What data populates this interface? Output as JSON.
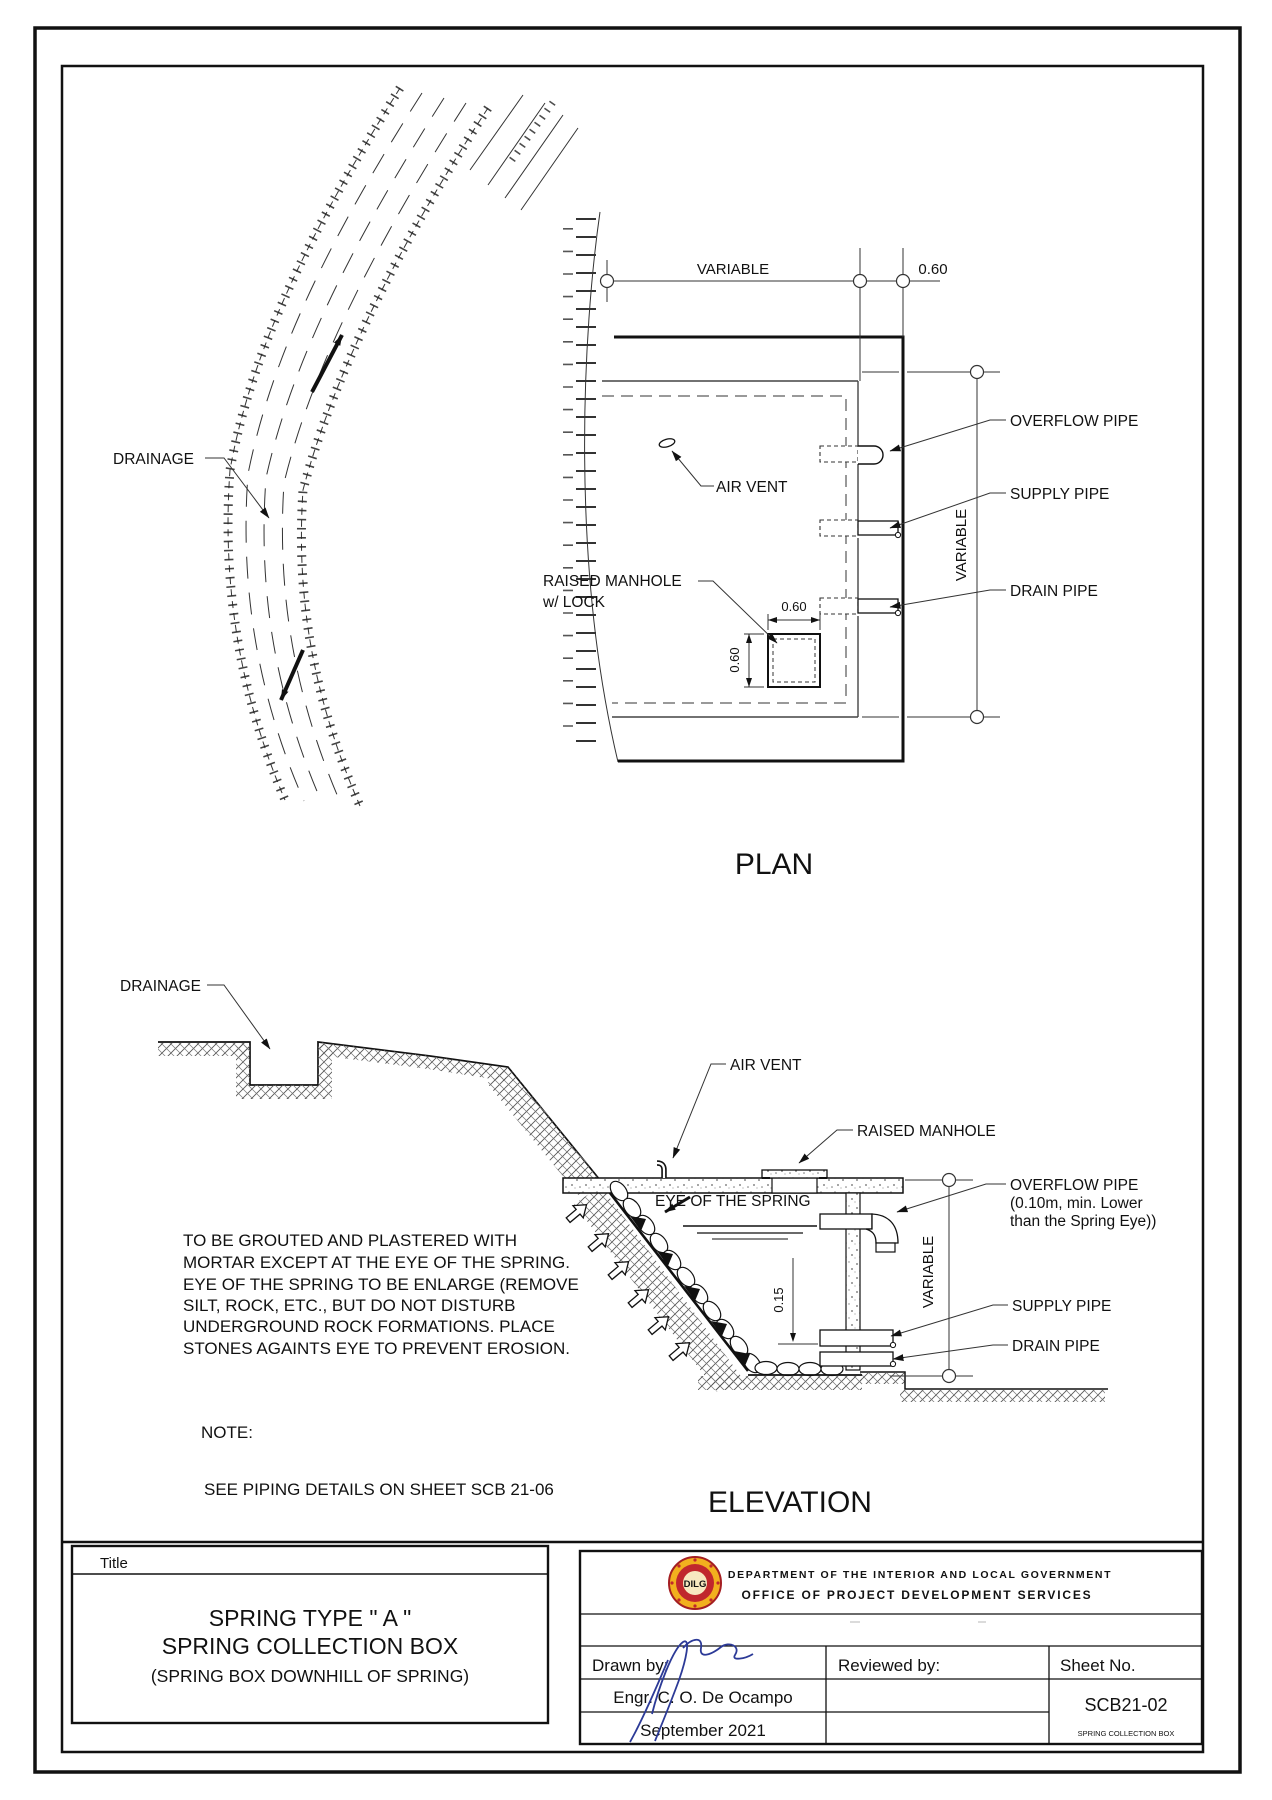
{
  "sheet": {
    "plan": {
      "title": "PLAN",
      "dim_variable_top": "VARIABLE",
      "dim_060_top": "0.60",
      "dim_variable_right": "VARIABLE",
      "manhole_width": "0.60",
      "manhole_height": "0.60",
      "labels": {
        "drainage": "DRAINAGE",
        "air_vent": "AIR VENT",
        "raised_manhole_line1": "RAISED MANHOLE",
        "raised_manhole_line2": "w/ LOCK",
        "overflow_pipe": "OVERFLOW PIPE",
        "supply_pipe": "SUPPLY PIPE",
        "drain_pipe": "DRAIN PIPE"
      }
    },
    "elevation": {
      "title": "ELEVATION",
      "dim_variable": "VARIABLE",
      "dim_015": "0.15",
      "labels": {
        "drainage": "DRAINAGE",
        "air_vent": "AIR VENT",
        "raised_manhole": "RAISED MANHOLE",
        "eye_of_spring": "EYE OF THE SPRING",
        "overflow_line1": "OVERFLOW PIPE",
        "overflow_line2": "(0.10m, min. Lower",
        "overflow_line3": "than the Spring Eye))",
        "supply_pipe": "SUPPLY PIPE",
        "drain_pipe": "DRAIN PIPE"
      },
      "notes_paragraph": [
        "TO BE GROUTED AND PLASTERED WITH",
        "MORTAR EXCEPT AT THE EYE OF THE SPRING.",
        "EYE OF THE SPRING TO BE ENLARGE (REMOVE",
        "SILT, ROCK, ETC., BUT DO NOT DISTURB",
        "UNDERGROUND ROCK FORMATIONS.  PLACE",
        "STONES AGAINTS EYE TO PREVENT EROSION."
      ],
      "note_heading": "NOTE:",
      "note_text": "SEE PIPING DETAILS ON SHEET SCB 21-06"
    },
    "title_block": {
      "title_label": "Title",
      "title_line1": "SPRING TYPE \" A \"",
      "title_line2": "SPRING COLLECTION BOX",
      "title_line3": "(SPRING BOX DOWNHILL OF SPRING)",
      "agency_line1": "DEPARTMENT OF THE INTERIOR AND LOCAL GOVERNMENT",
      "agency_line2": "OFFICE OF PROJECT DEVELOPMENT SERVICES",
      "logo_text": "DILG",
      "drawn_by_label": "Drawn by:",
      "reviewed_by_label": "Reviewed by:",
      "sheet_no_label": "Sheet No.",
      "drawn_by_name": "Engr. C. O. De Ocampo",
      "drawn_date": "September 2021",
      "sheet_no": "SCB21-02",
      "sheet_subtitle": "SPRING COLLECTION BOX"
    }
  }
}
